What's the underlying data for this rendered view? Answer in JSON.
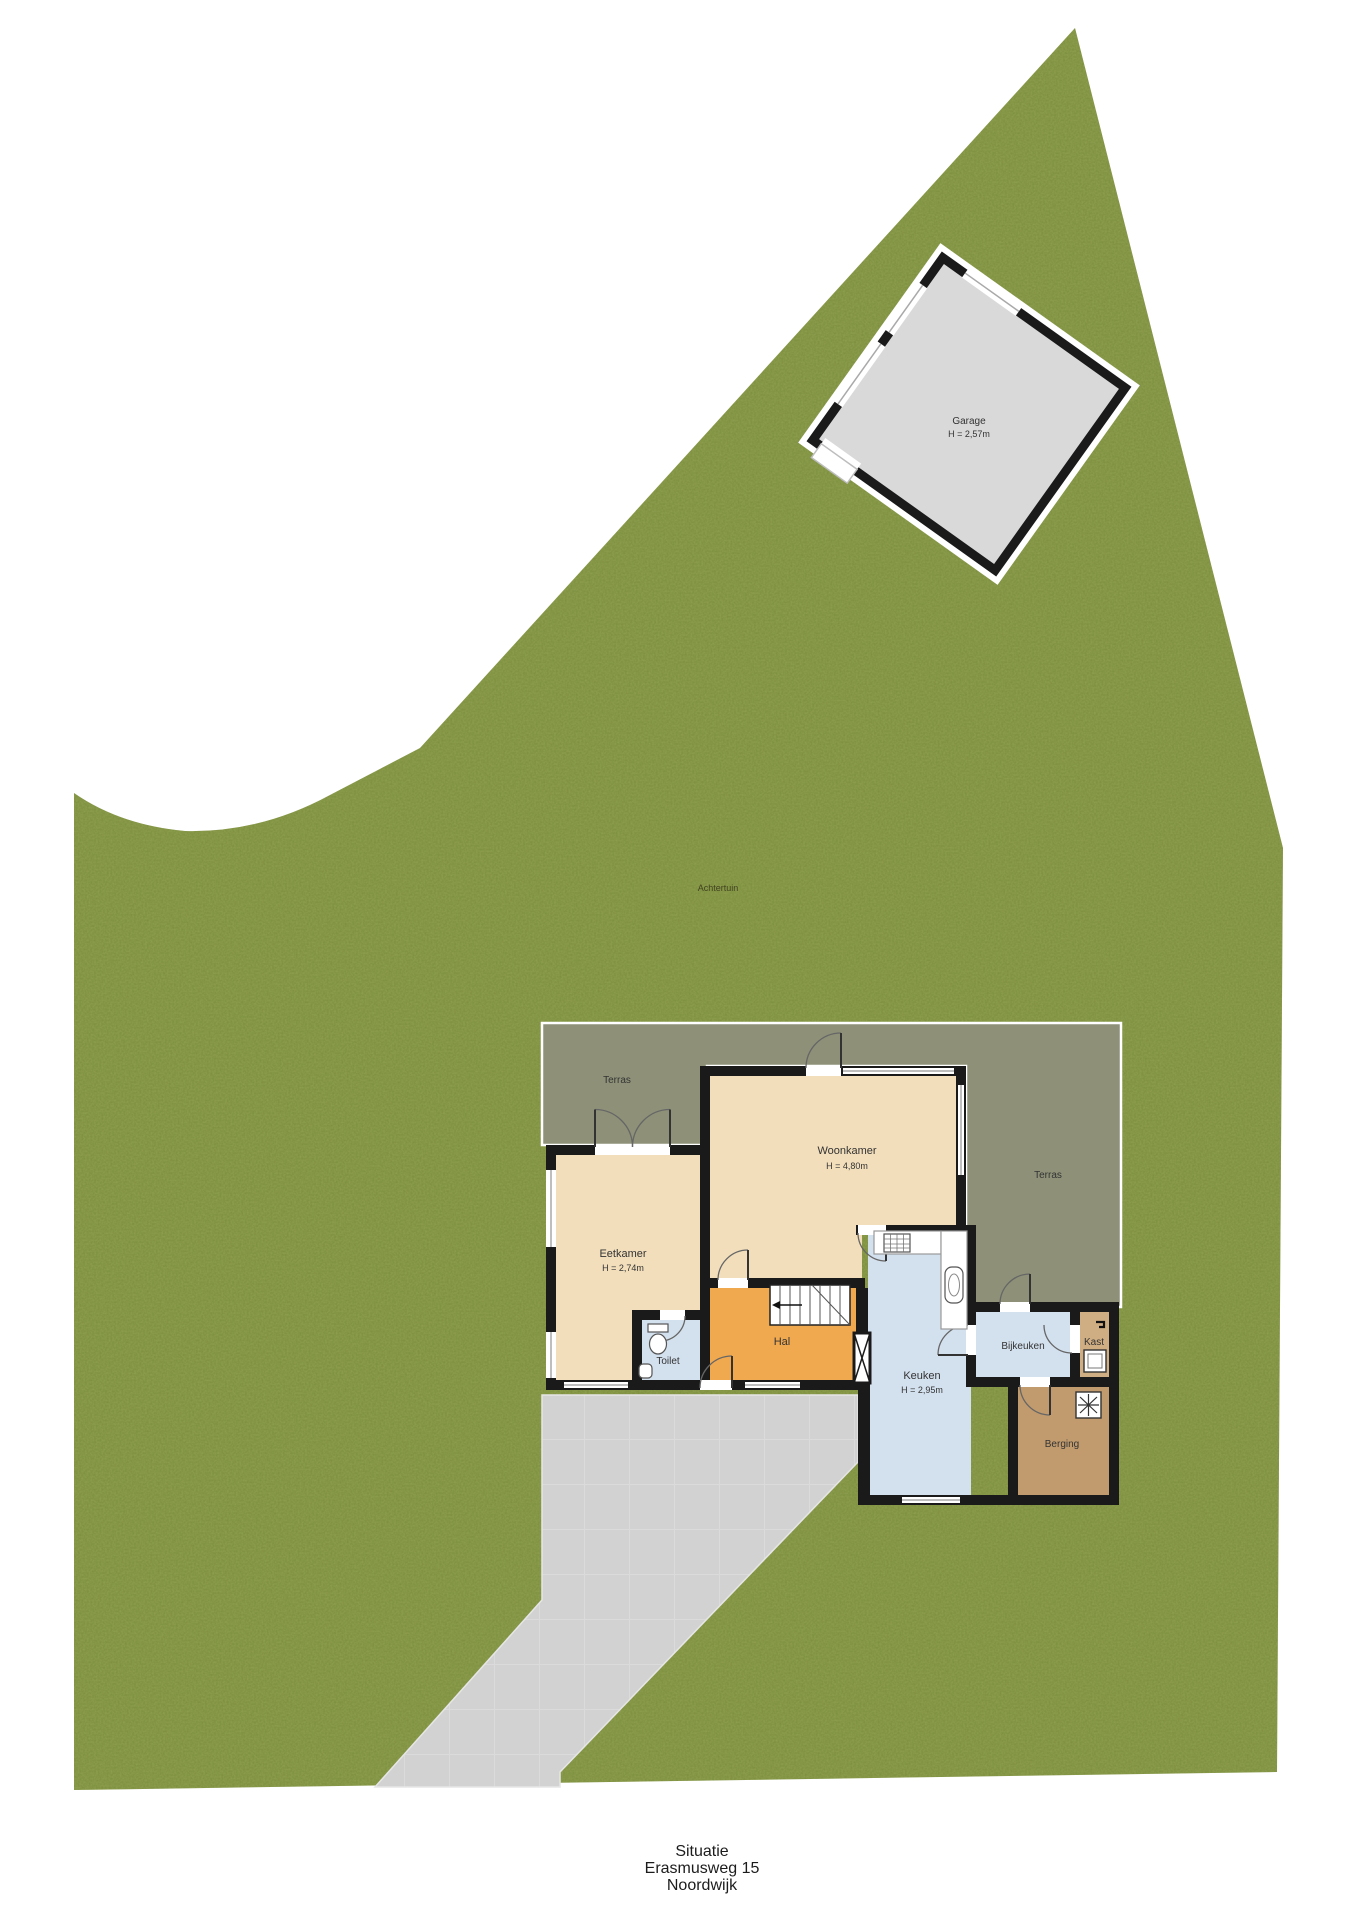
{
  "plan": {
    "backyard_label": "Achtertuin",
    "garage": {
      "name": "Garage",
      "height": "H = 2,57m"
    },
    "rooms": {
      "terras_left": {
        "name": "Terras"
      },
      "terras_right": {
        "name": "Terras"
      },
      "woonkamer": {
        "name": "Woonkamer",
        "height": "H = 4,80m"
      },
      "eetkamer": {
        "name": "Eetkamer",
        "height": "H = 2,74m"
      },
      "keuken": {
        "name": "Keuken",
        "height": "H = 2,95m"
      },
      "toilet": {
        "name": "Toilet"
      },
      "hal": {
        "name": "Hal"
      },
      "bijkeuken": {
        "name": "Bijkeuken"
      },
      "kast": {
        "name": "Kast"
      },
      "berging": {
        "name": "Berging"
      }
    },
    "caption": {
      "line1": "Situatie",
      "line2": "Erasmusweg 15",
      "line3": "Noordwijk"
    },
    "colors": {
      "grass": "#7a8e3d",
      "terrace": "#8e9178",
      "living_cream": "#f2debb",
      "hall_orange": "#f1a950",
      "wet_blue": "#d3e0ee",
      "storage_tan": "#c19b6d",
      "closet_tan": "#cfae83",
      "wall_black": "#1a1a1a",
      "pavement_gray": "#d2d2d2",
      "garage_floor": "#d9d9d9"
    }
  }
}
